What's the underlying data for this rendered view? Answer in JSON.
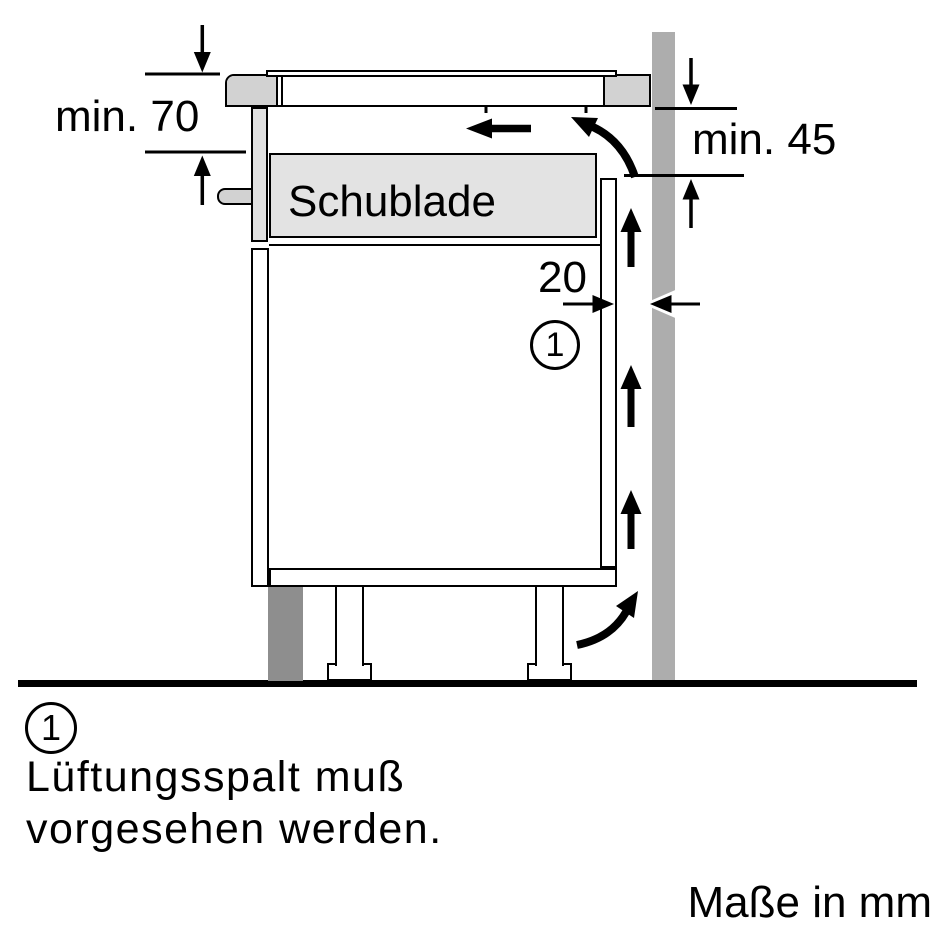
{
  "diagram": {
    "drawer_label": "Schublade",
    "dims": {
      "clearance_below_worktop": "min. 70",
      "clearance_rear_top": "min. 45",
      "ventilation_gap": "20"
    },
    "callout": {
      "number": "1"
    },
    "legend": {
      "number": "1",
      "line1": "Lüftungsspalt muß",
      "line2": "vorgesehen werden."
    },
    "units_note": "Maße in mm"
  },
  "colors": {
    "line": "#000000",
    "wall": "#adadad",
    "worktop_cap": "#d2d2d2",
    "drawer_fill": "#e3e3e3",
    "front_panel_fill": "#e0e0e0",
    "handle_fill": "#d2d2d2",
    "plinth_fill": "#8e8e8e",
    "background": "#ffffff"
  }
}
